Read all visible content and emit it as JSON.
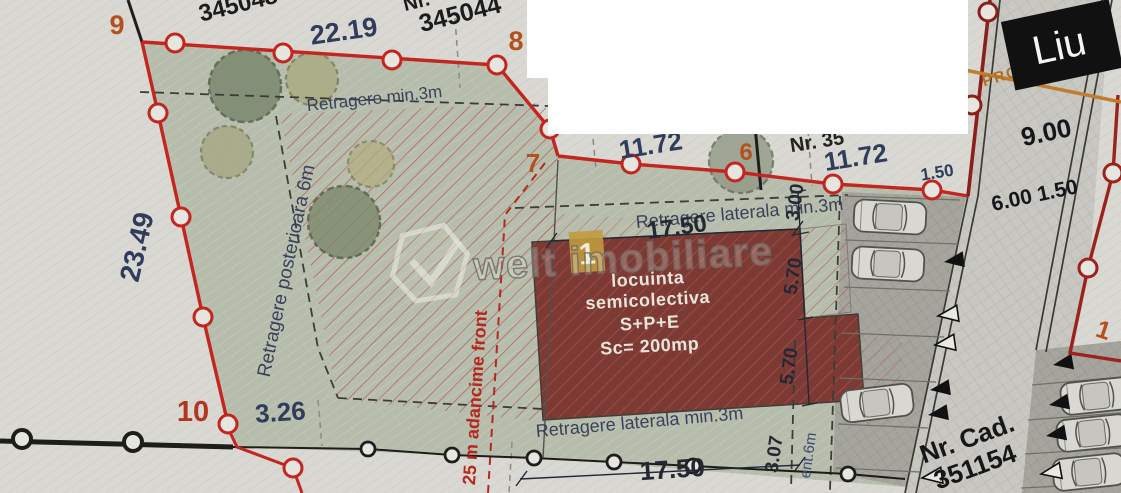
{
  "plan": {
    "parcels": {
      "neighbor_top_left": "345048",
      "neighbor_top_right_prefix": "Nr.",
      "neighbor_top_right_number": "345044",
      "partially_covered_number": "Nr. 35",
      "cadastral_prefix": "Nr. Cad.",
      "cadastral_number": "351154",
      "street_cover_label": "Liu",
      "street_profile_label": "PROFIL B"
    },
    "markers": {
      "v9": "9",
      "v8": "8",
      "v7": "7",
      "v6": "6",
      "v10": "10",
      "plot_across_street": "1",
      "building_no": "1"
    },
    "dimensions": {
      "top_width": "22.19",
      "left_depth": "23.49",
      "bottom_offset": "3.26",
      "front_left": "11.72",
      "front_right": "11.72",
      "front_small": "1.50",
      "building_width_top": "17.50",
      "building_width_bottom": "17.50",
      "side_retreat": "3.00",
      "building_depth_upper": "5.70",
      "building_depth_lower": "5.70",
      "rear_offset": "3.07",
      "alignment_partial": "ent.6m",
      "street_width": "9.00",
      "street_lane_widths": "6.00 1.50"
    },
    "annotations": {
      "retreat_front": "Retragere min.3m",
      "retreat_rear": "Retragere posterioara 6m",
      "retreat_lateral_top": "Retragere laterala min.3m",
      "retreat_lateral_bottom": "Retragere laterala min.3m",
      "depth_note": "25 m adancime front",
      "building_line1": "locuinta",
      "building_line2": "semicolectiva",
      "building_line3": "S+P+E",
      "building_line4": "Sc= 200mp"
    },
    "watermark": {
      "brand": "welt imobiliare"
    },
    "colors": {
      "boundary_red": "#c3251f",
      "street_maroon": "#8a1f1c",
      "marker_orange": "#b2511e",
      "dimension_navy": "#2f3c5a",
      "building_fill": "#7c3a34",
      "highlight_gold": "#c09b3e",
      "profile_orange": "#b26f24"
    }
  }
}
